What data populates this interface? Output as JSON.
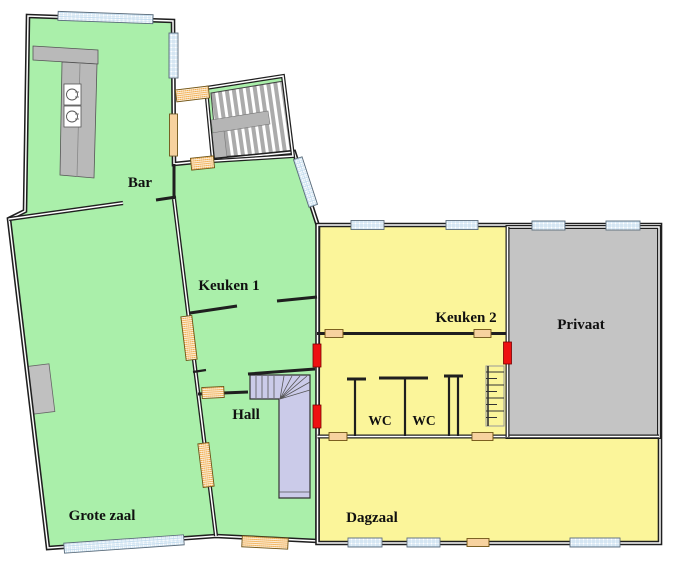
{
  "plan": {
    "rooms": {
      "bar": {
        "label": "Bar",
        "color": "#aaefaa"
      },
      "keuken1": {
        "label": "Keuken 1",
        "color": "#aaefaa"
      },
      "keuken2": {
        "label": "Keuken 2",
        "color": "#fbf59a"
      },
      "privaat": {
        "label": "Privaat",
        "color": "#c4c4c4"
      },
      "hall": {
        "label": "Hall",
        "color": "#aaefaa"
      },
      "wc1": {
        "label": "WC",
        "color": "#fbf59a"
      },
      "wc2": {
        "label": "WC",
        "color": "#fbf59a"
      },
      "grotezaal": {
        "label": "Grote zaal",
        "color": "#aaefaa"
      },
      "dagzaal": {
        "label": "Dagzaal",
        "color": "#fbf59a"
      }
    },
    "colors": {
      "background": "#ffffff",
      "wall": "#1f1f1f",
      "green_room": "#aaefaa",
      "yellow_room": "#fbf59a",
      "gray_room": "#c4c4c4",
      "stairs": "#cbcbe9",
      "door": "#f0a844",
      "window_hatch": "#b9d6ec",
      "red_door": "#ee1111",
      "counter": "#b9b9b9"
    },
    "symbols": {
      "window": "blue-hatched wall opening",
      "door": "orange-hatched wall opening",
      "red_door": "red door marker",
      "stairs_upper": "striped double flight",
      "stairs_hall": "L-shaped winder stair",
      "sink": "basin circle in square",
      "bar_counter": "L-shaped gray counter",
      "wall_fixture": "gray rectangle fixture",
      "ladder": "rung ladder"
    }
  }
}
